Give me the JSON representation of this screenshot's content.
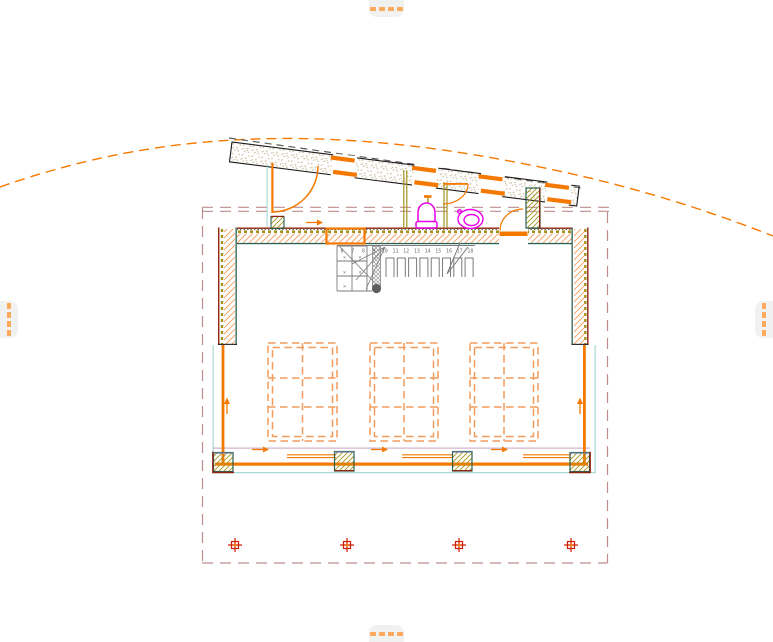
{
  "app": {
    "type": "cad-plan-viewport",
    "view": "floor-plan-with-roof-overlay"
  },
  "colors": {
    "orange": "#f57900",
    "orange_light": "#f29b5c",
    "handle_bg": "#f1f1f2",
    "handle_dash": "#ffa95f",
    "maroon": "#8e2411",
    "rose": "#bd8d8d",
    "teal": "#2a6152",
    "cyan": "#93d2cb",
    "olive": "#a3931d",
    "tan": "#c2b08d",
    "gray": "#7b7b7b",
    "roofline": "#5c5c5c",
    "magenta": "#ea00ea",
    "red": "#cf1d0b",
    "slate": "#7e88ab",
    "lavender": "#c7a3bd",
    "black": "#1b1b1b"
  },
  "edge_controls": {
    "top": {
      "icon": "pan-handle-horizontal-dashes-icon"
    },
    "bottom": {
      "icon": "pan-handle-horizontal-dashes-icon"
    },
    "left": {
      "icon": "pan-handle-vertical-dashes-icon"
    },
    "right": {
      "icon": "pan-handle-vertical-dashes-icon"
    },
    "dash_count": 4
  },
  "plan": {
    "stair": {
      "tread_numbers": [
        "6",
        "7",
        "8",
        "9",
        "10",
        "11",
        "12",
        "13",
        "14",
        "15",
        "16",
        "17",
        "18"
      ],
      "winder_mark": "×"
    },
    "skylights": {
      "count": 3,
      "grid": "2x3"
    },
    "top_windows": {
      "count": 4
    },
    "doors": {
      "count": 3
    },
    "fixtures": [
      "toilet",
      "bidet"
    ],
    "survey_markers": {
      "count": 4
    }
  }
}
